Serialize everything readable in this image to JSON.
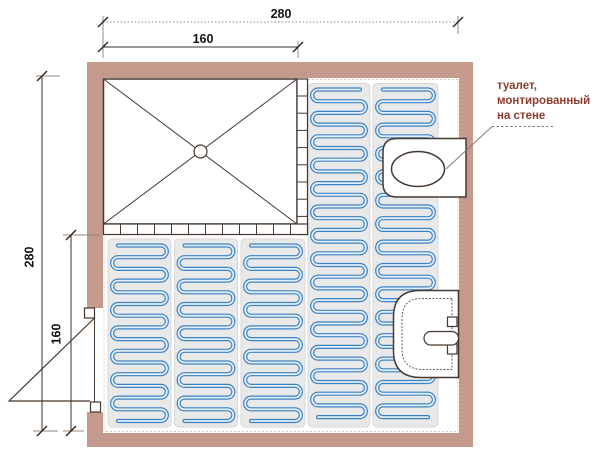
{
  "dimensions": {
    "top_total": "280",
    "shower_width": "160",
    "left_total": "280",
    "floor_depth": "160"
  },
  "annotation": {
    "line1": "туалет,",
    "line2": "монтированный",
    "line3": "на стене"
  },
  "colors": {
    "wall": "#c49a8c",
    "wall_dotted_edge": "#dcc8bd",
    "outline": "#46372f",
    "mat": "#e9e9e9",
    "mat_border": "#d7d7d7",
    "coil": "#3c82c3",
    "coil_light": "#e4eef8",
    "dim_line": "#9a8878",
    "tick": "#2a2520",
    "annotation_text": "#8c3c2d",
    "leader": "#8a7a6e",
    "sink_inner_line": "#6b5a50"
  }
}
